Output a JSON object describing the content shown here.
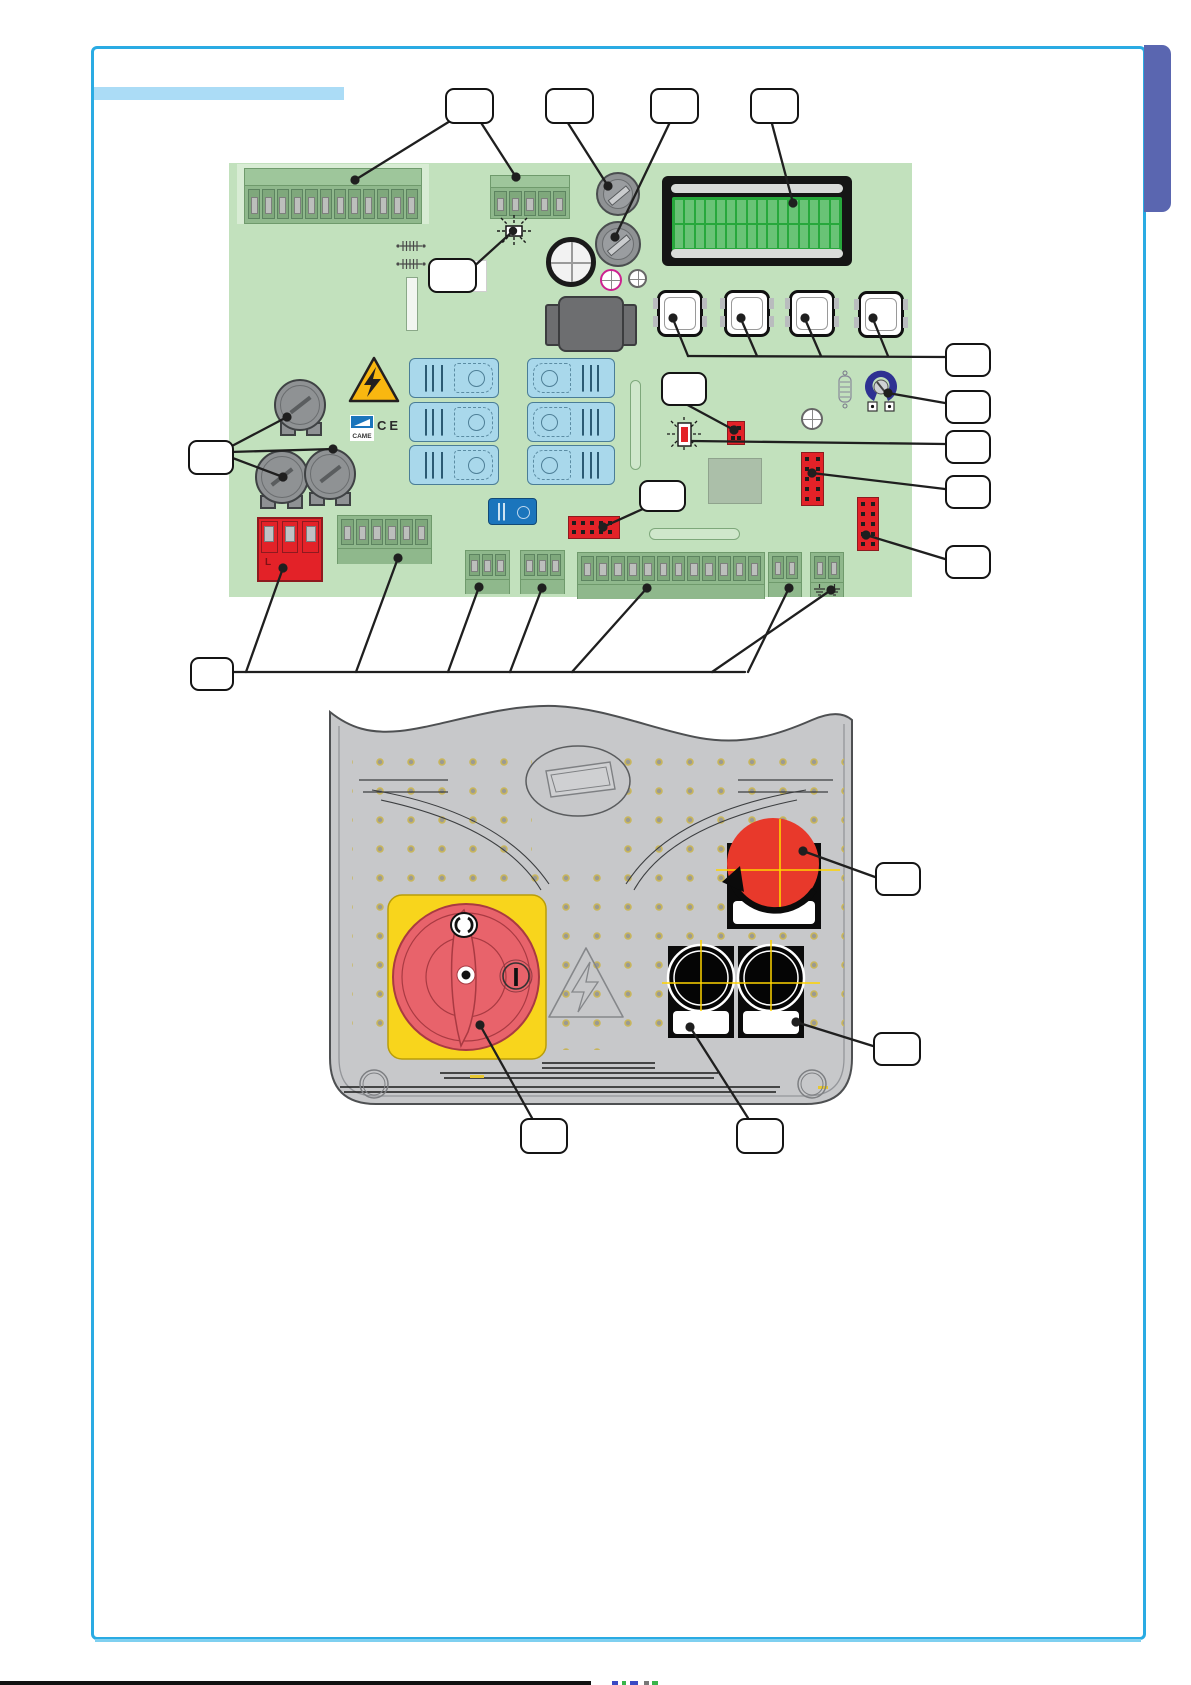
{
  "page": {
    "background": "#ffffff"
  },
  "colors": {
    "frame": "#2aabe3",
    "title_bar": "#abdcf6",
    "side_tab": "#5a66b0",
    "board": "#c2e1bd",
    "board_light": "#d8ecd4",
    "terminal": "#8fb88c",
    "terminal_head": "#9ec69b",
    "pin_metal": "#bcbfbc",
    "red": "#e32228",
    "red_dark": "#8e1a1f",
    "relay": "#a9d8eb",
    "relay_dark": "#1b75bc",
    "lcd": "#27a83c",
    "lcd_cell": "#7bc985",
    "warning_yellow": "#f9b710",
    "cover": "#c7c8ca",
    "plate_yellow": "#f8d51c",
    "switch_red": "#e8636b",
    "estop_red": "#e8392b",
    "cross_yellow": "#ffd400",
    "pot_blue": "#2e3192",
    "logo_blue": "#1b75bc",
    "footer": "#111111"
  },
  "labels": {
    "came_logo": "CAME",
    "ce_mark": "CE",
    "switch_on_symbol": "I",
    "switch_off_symbol": "O",
    "line_terminal_mark": "L"
  },
  "pcb": {
    "lcd": {
      "rows": 2,
      "cols": 16
    },
    "terminal_blocks": {
      "control": 12,
      "power": 5,
      "line_red": 3,
      "motor": 6,
      "aux_left": 3,
      "aux_right": 3,
      "io": 12,
      "antenna": 2,
      "ground": 2
    },
    "push_buttons": 4,
    "fuses": 2,
    "light_relays": 6,
    "dark_relays": 1,
    "capacitors": 3,
    "callout_boxes": [
      "terminal-blocks",
      "line-fuse",
      "accessories-fuse",
      "display",
      "signal-led",
      "capacitors",
      "memory-connector",
      "jumper",
      "programming-buttons",
      "trimmer",
      "board-led",
      "pin-connector-upper",
      "pin-connector-lower",
      "bottom-terminals"
    ]
  },
  "cover": {
    "callout_boxes": [
      "emergency-stop-button",
      "main-disconnect-switch",
      "selector-knobs",
      "knob-label"
    ]
  }
}
